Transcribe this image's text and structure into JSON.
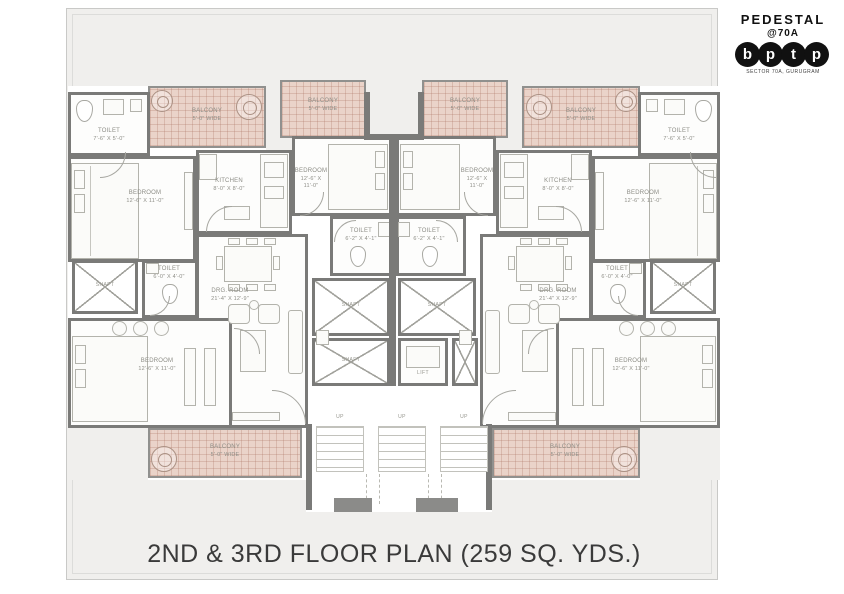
{
  "logo": {
    "brand_top": "PEDESTAL",
    "brand_sub": "@70A",
    "brand_letters": [
      "b",
      "p",
      "t",
      "p"
    ],
    "brand_tagline": "SECTOR 70A, GURUGRAM"
  },
  "title": "2ND & 3RD FLOOR PLAN (259 SQ. YDS.)",
  "rooms": {
    "bedroom": {
      "label": "BEDROOM",
      "dims": "12'-6\" X 11'-0\""
    },
    "kitchen": {
      "label": "KITCHEN",
      "dims": "8'-0\" X 8'-0\""
    },
    "drg_room": {
      "label": "DRG. ROOM",
      "dims": "21'-4\" X 12'-9\""
    },
    "toilet_corner": {
      "label": "TOILET",
      "dims": "7'-6\" X 5'-0\""
    },
    "toilet_small": {
      "label": "TOILET",
      "dims": "6'-0\" X 4'-0\""
    },
    "toilet_center": {
      "label": "TOILET",
      "dims": "6'-2\" X 4'-1\""
    },
    "balcony": {
      "label": "BALCONY",
      "dims": "5'-0\" WIDE"
    },
    "shaft": {
      "label": "SHAFT"
    },
    "lift": {
      "label": "LIFT"
    },
    "stairs": {
      "up": "UP"
    }
  }
}
